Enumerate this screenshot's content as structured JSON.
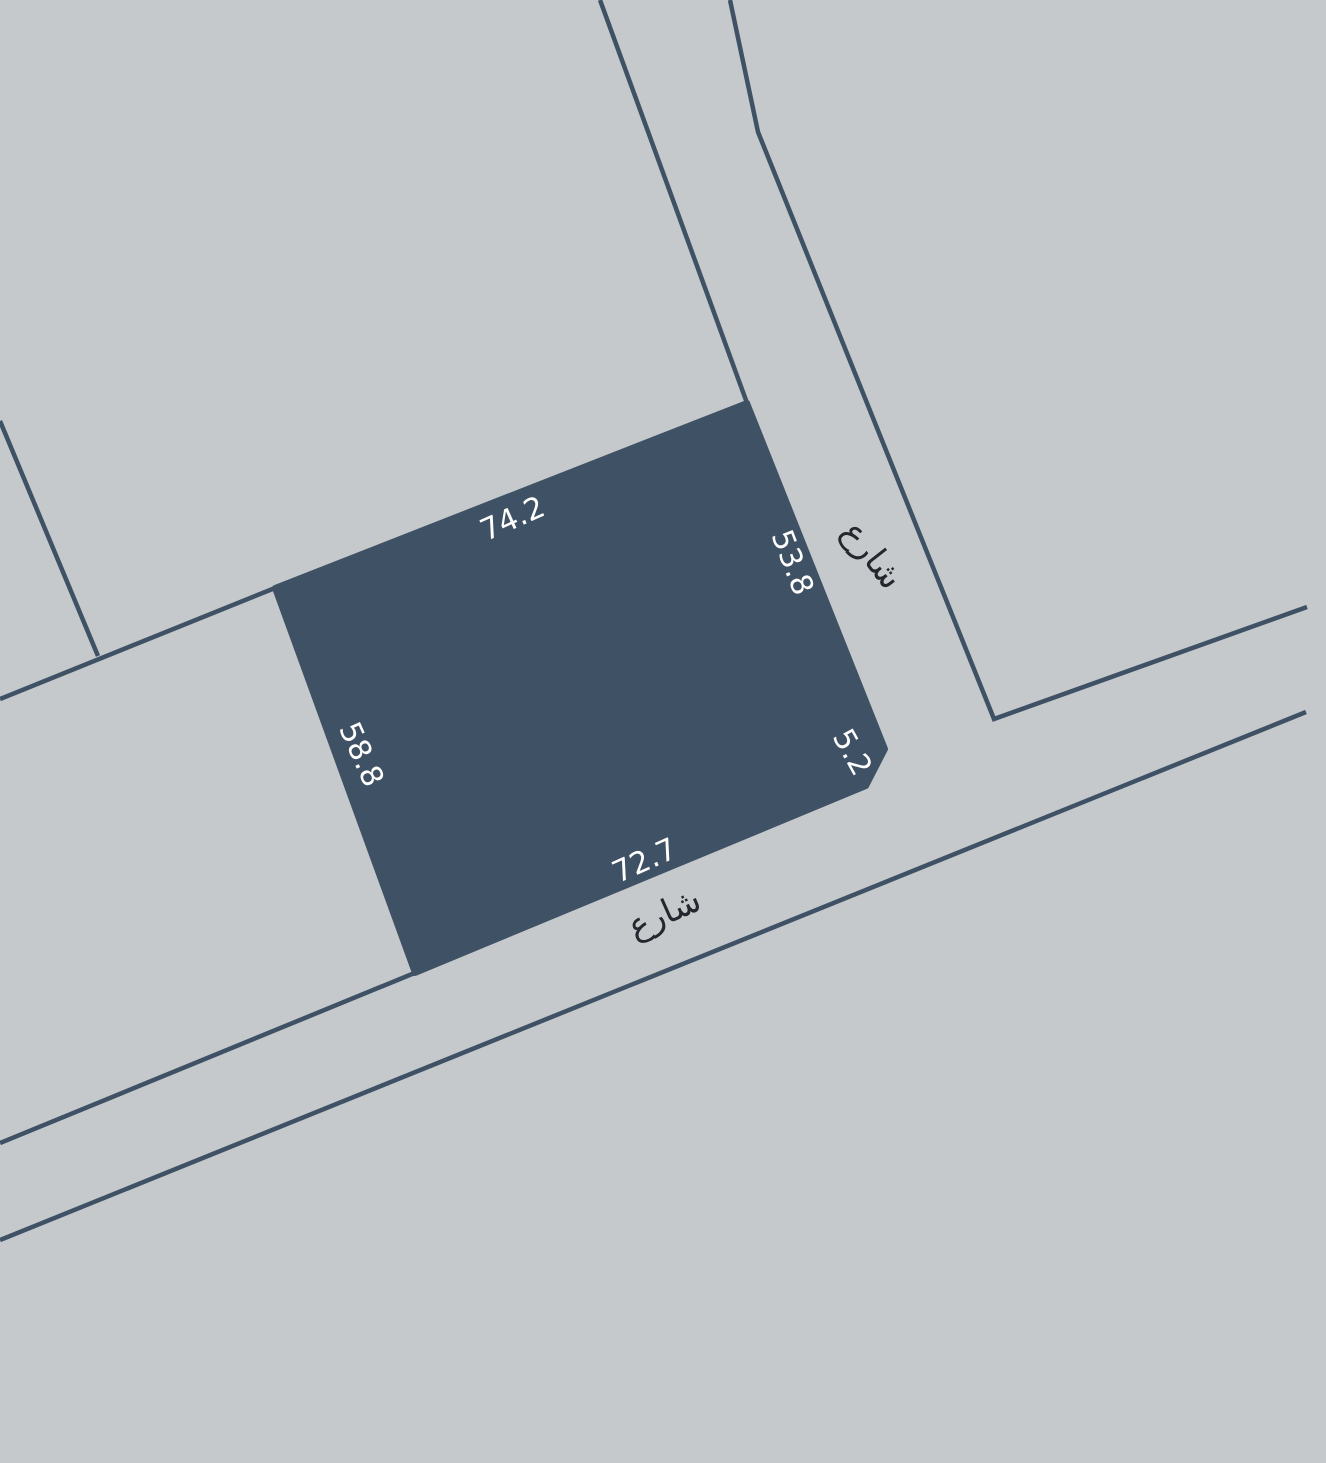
{
  "map": {
    "background_color": "#c5c9cc",
    "feature_color": "#3f5164",
    "label_light_color": "#ffffff",
    "label_dark_color": "#23282e",
    "parcel": {
      "name": "parcel-polygon",
      "points": "275,588 747,403 885,749 866,786 415,973",
      "stroke_width": 6,
      "dimensions": {
        "top": "74.2",
        "right": "53.8",
        "corner_cut": "5.2",
        "bottom": "72.7",
        "left": "58.8"
      }
    },
    "roads": [
      {
        "name": "street-edge-vertical-west",
        "points": "600,0 747,403",
        "width": 4.5
      },
      {
        "name": "street-edge-vertical-east",
        "points": "730,0 758,132 994,719 1307,607",
        "width": 4.5
      },
      {
        "name": "street-edge-horizontal-north-west",
        "points": "0,1143 417,972",
        "width": 4.5
      },
      {
        "name": "street-edge-horizontal-south",
        "points": "0,1240 1306,712",
        "width": 4.5
      },
      {
        "name": "block-boundary-west",
        "points": "0,699 275,588",
        "width": 4.5
      },
      {
        "name": "block-inner-boundary",
        "points": "0,421 98,656",
        "width": 4.5
      }
    ],
    "labels": [
      {
        "name": "dimension-label-top",
        "text": "74.2",
        "x": 513,
        "y": 520,
        "rot": -24,
        "size": 30,
        "tone": "light"
      },
      {
        "name": "dimension-label-right",
        "text": "53.8",
        "x": 791,
        "y": 563,
        "rot": 69,
        "size": 30,
        "tone": "light"
      },
      {
        "name": "dimension-label-corner",
        "text": "5.2",
        "x": 851,
        "y": 753,
        "rot": 61,
        "size": 30,
        "tone": "light"
      },
      {
        "name": "dimension-label-bottom",
        "text": "72.7",
        "x": 645,
        "y": 862,
        "rot": -24,
        "size": 30,
        "tone": "light"
      },
      {
        "name": "dimension-label-left",
        "text": "58.8",
        "x": 360,
        "y": 755,
        "rot": 66,
        "size": 30,
        "tone": "light"
      },
      {
        "name": "street-label-south",
        "text": "شارع",
        "x": 665,
        "y": 915,
        "rot": -24,
        "size": 34,
        "tone": "dark"
      },
      {
        "name": "street-label-east",
        "text": "شارع",
        "x": 871,
        "y": 556,
        "rot": 52,
        "size": 34,
        "tone": "dark"
      }
    ]
  }
}
